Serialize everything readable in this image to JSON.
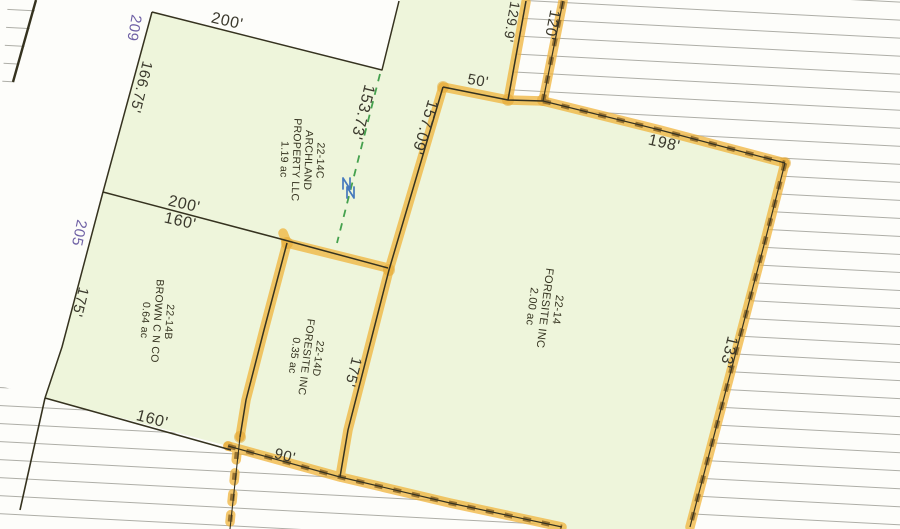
{
  "map": {
    "type": "scanned parcel plat map",
    "parcel_blocks": [
      {
        "id": "p_archland",
        "lines": [
          "22-14C",
          "ARCHLAND",
          "PROPERTY LLC",
          "1.19 ac"
        ]
      },
      {
        "id": "p_foresite",
        "lines": [
          "22-14",
          "FORESITE INC",
          "2.00 ac"
        ]
      },
      {
        "id": "p_foresited",
        "lines": [
          "22-14D",
          "FORESITE INC",
          "0.35 ac"
        ]
      },
      {
        "id": "p_brown",
        "lines": [
          "22-14B",
          "BROWN C N CO",
          "0.64 ac"
        ]
      }
    ],
    "dimension_labels": [
      {
        "id": "d200_top",
        "text": "200'"
      },
      {
        "id": "d166",
        "text": "166.75'"
      },
      {
        "id": "d153",
        "text": "153.73'"
      },
      {
        "id": "d157",
        "text": "157.09'"
      },
      {
        "id": "d50",
        "text": "50'"
      },
      {
        "id": "d129",
        "text": "129.9'"
      },
      {
        "id": "d120",
        "text": "120'"
      },
      {
        "id": "d198",
        "text": "198'"
      },
      {
        "id": "d133",
        "text": "133'"
      },
      {
        "id": "d200_mid",
        "text": "200'"
      },
      {
        "id": "d160_mid",
        "text": "160'"
      },
      {
        "id": "d175_left",
        "text": "175'"
      },
      {
        "id": "d160_bot",
        "text": "160'"
      },
      {
        "id": "d90",
        "text": "90'"
      },
      {
        "id": "d175_mid",
        "text": "175'"
      }
    ],
    "road_frontage_labels": [
      {
        "id": "r209",
        "text": "209"
      },
      {
        "id": "r205",
        "text": "205"
      }
    ],
    "symbols": {
      "blue_double_n_mark": "NN",
      "survey_split_line": "green dashed line 153.73'"
    },
    "colors": {
      "highlighter_orange": "#f0b43c",
      "dash_brown": "#8e6a2c",
      "parcel_fill_green": "#eef5db",
      "ruled_line_gray": "#9a9a92",
      "ink_black": "#35321f",
      "road_frontage_purple": "#6f61a5",
      "survey_dash_green": "#45a14e",
      "north_mark_blue": "#4679bd"
    }
  }
}
